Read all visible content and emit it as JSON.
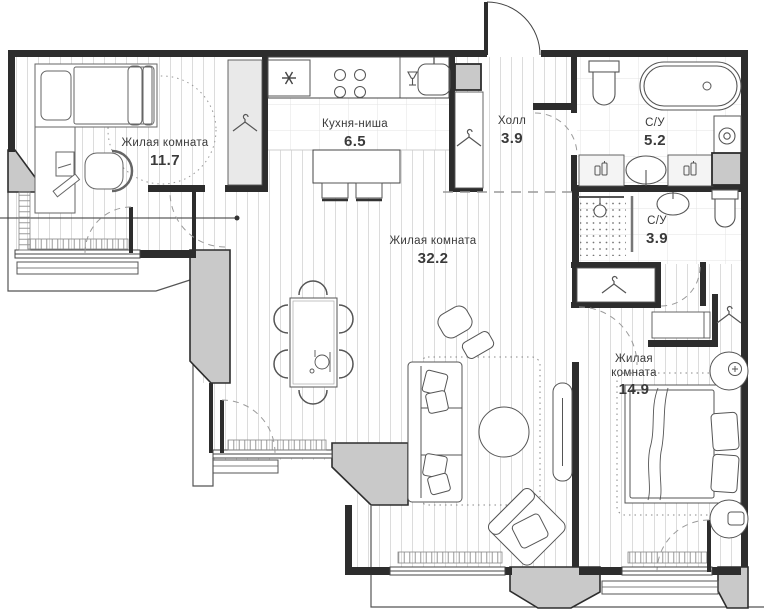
{
  "plan": {
    "rooms": {
      "bedroom1": {
        "name": "Жилая комната",
        "area": "11.7"
      },
      "kitchen": {
        "name": "Кухня-ниша",
        "area": "6.5"
      },
      "hall": {
        "name": "Холл",
        "area": "3.9"
      },
      "bath_large": {
        "name": "С/У",
        "area": "5.2"
      },
      "bath_small": {
        "name": "С/У",
        "area": "3.9"
      },
      "living": {
        "name": "Жилая комната",
        "area": "32.2"
      },
      "bedroom2": {
        "name_line1": "Жилая",
        "name_line2": "комната",
        "area": "14.9"
      }
    },
    "icons": {
      "hanger": "wardrobe-hanger",
      "asterisk": "fridge-freezer",
      "burners": "stove-burners",
      "glass": "dishwasher",
      "spiral": "washing-machine",
      "bottles": "toiletry-bottles",
      "place_setting": "dining-place-setting"
    },
    "colors": {
      "wall": "#2d2d2d",
      "pier_fill": "#c9c9c9",
      "floor_hatch": "#dcdcdc",
      "tile": "#e3e3e3",
      "label": "#3a3a3a",
      "dashed": "#9a9a9a"
    }
  }
}
